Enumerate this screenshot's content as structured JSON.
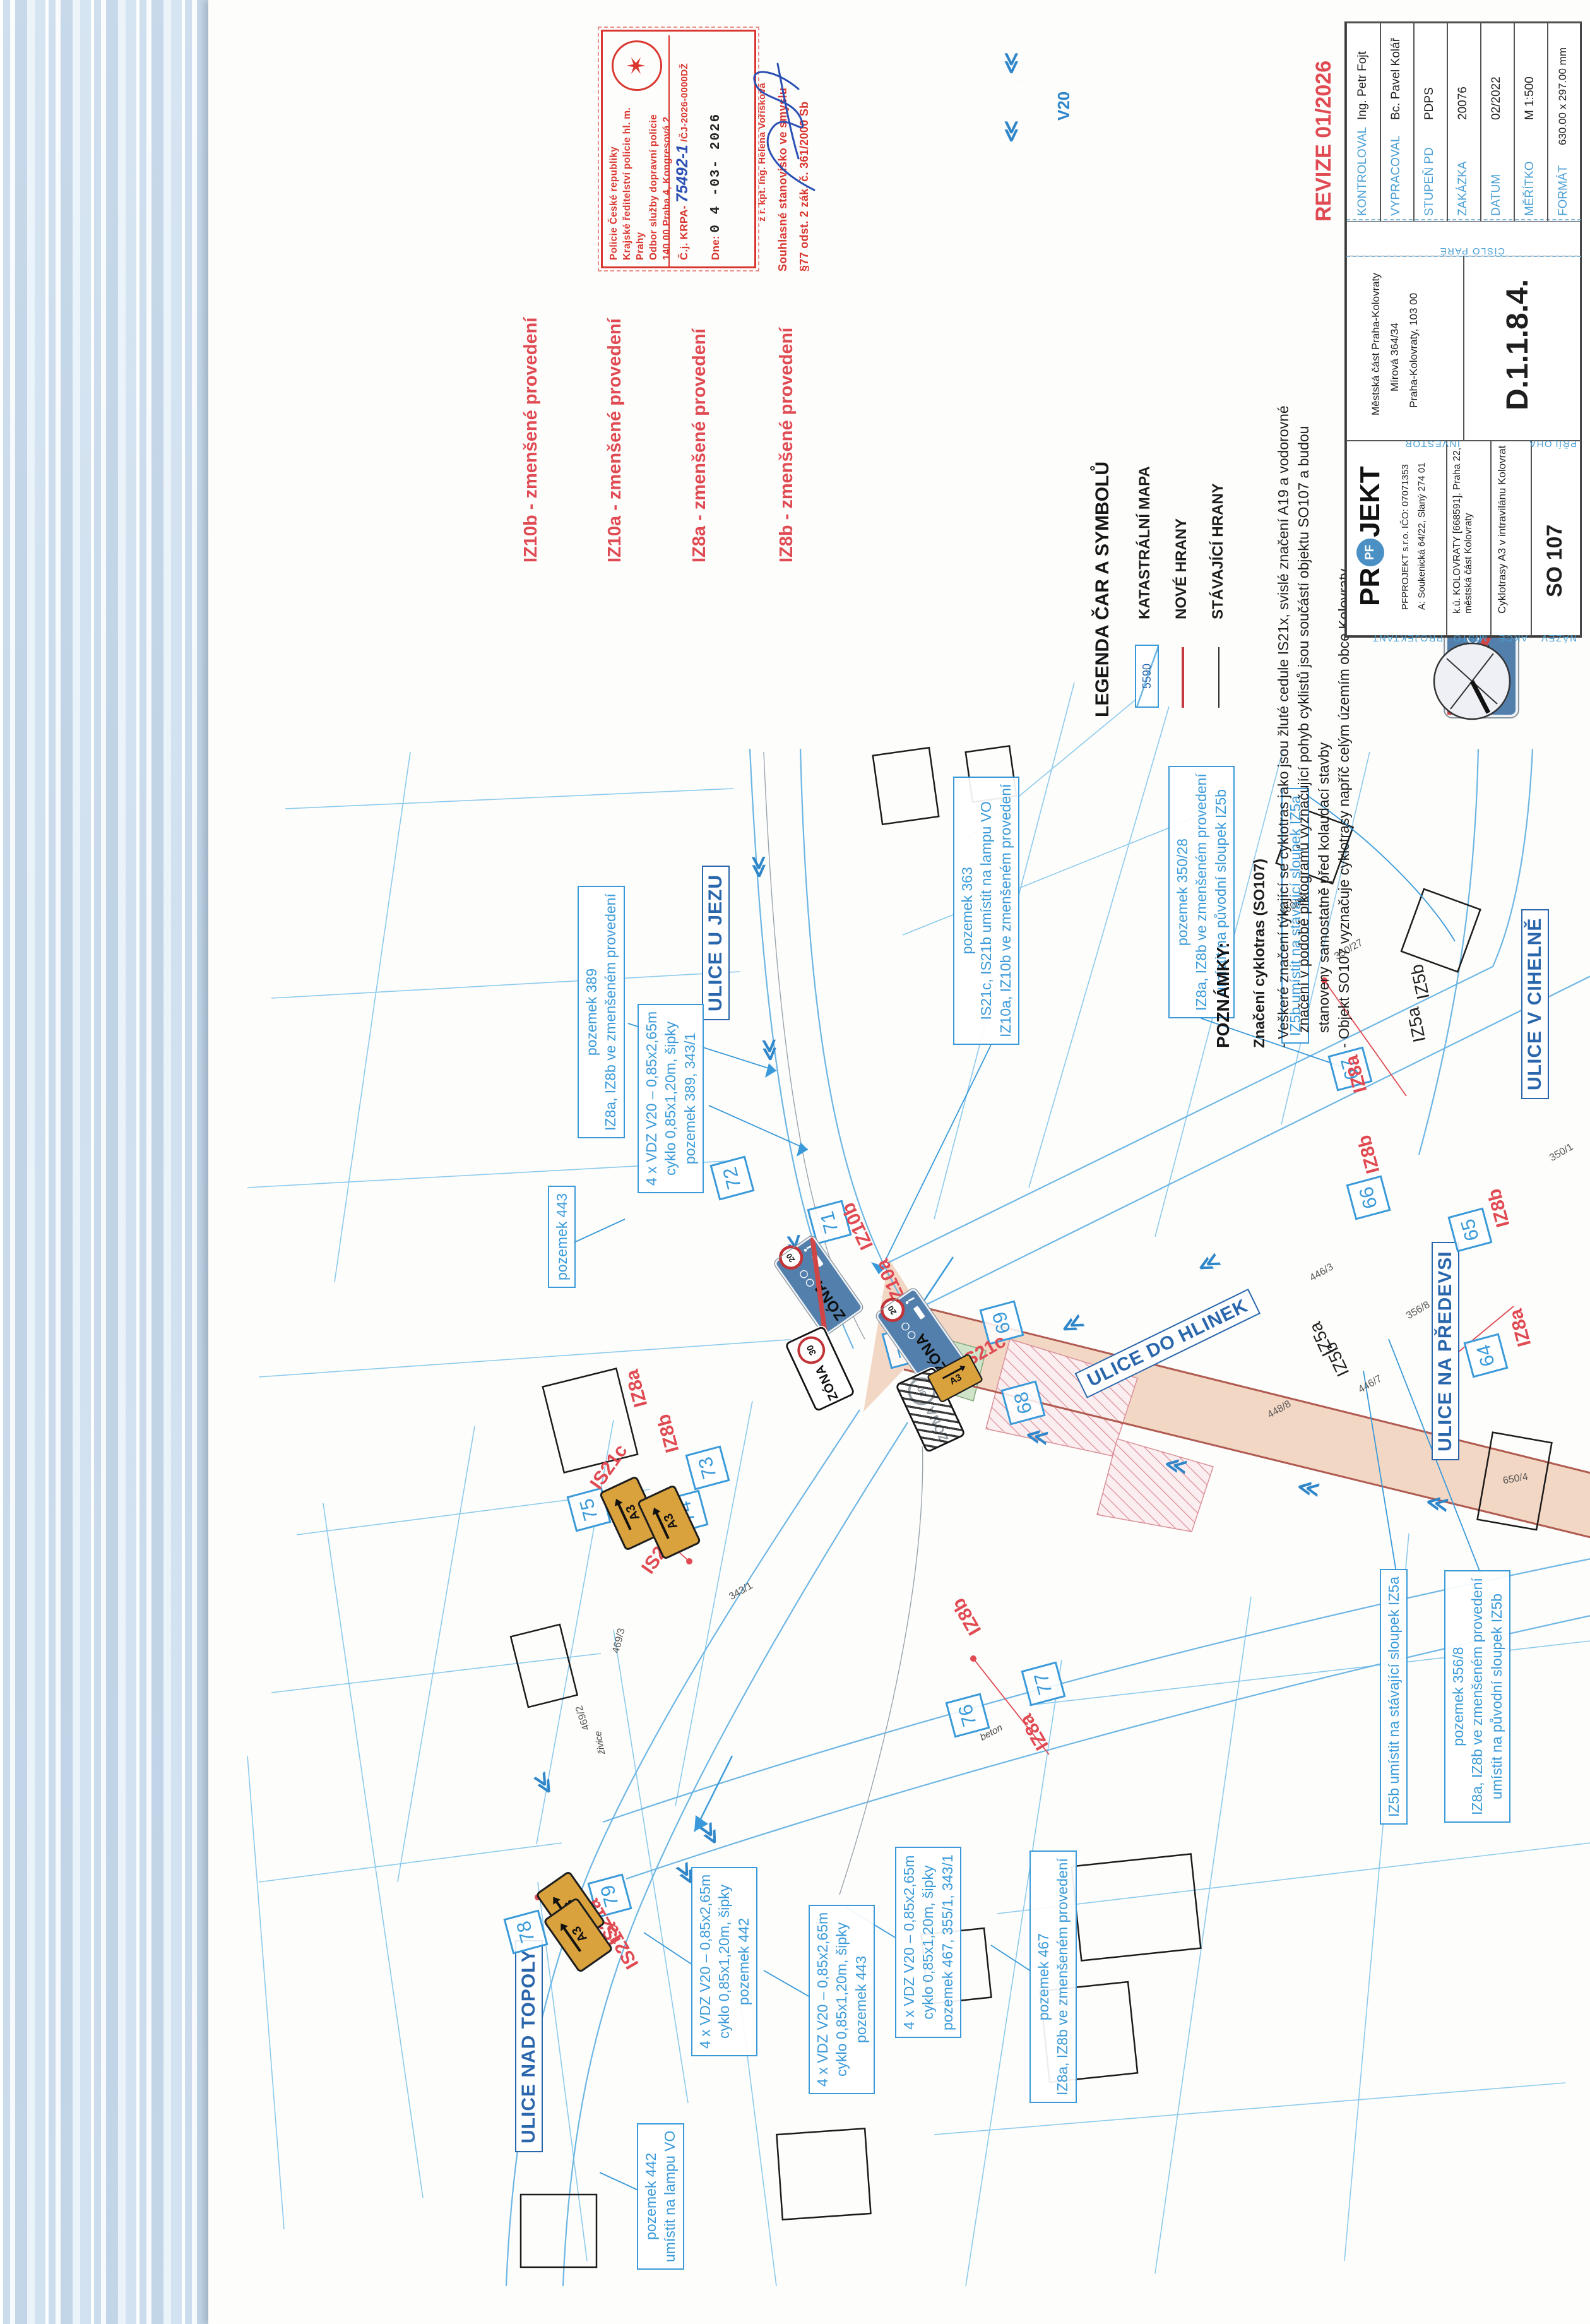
{
  "stamp": {
    "office_lines": [
      "Policie České republiky",
      "Krajské ředitelství policie hl. m. Prahy",
      "Odbor služby dopravní policie",
      "140 00 Praha 4, Kongresová 2"
    ],
    "cj_label": "Č.j. KRPA-",
    "cj_hand": "75492-1",
    "cj_suffix": "/ČJ-2026-0000DŽ",
    "dne_label": "Dne:",
    "dne_value": "0 4 -03- 2026",
    "approval_line1": "Souhlasné stanovisko ve smyslu",
    "approval_line2": "§77 odst. 2 zák. č. 361/2000 Sb",
    "signer": "z r. kpt. Ing. Helena Voříšková"
  },
  "v20": {
    "label": "V20"
  },
  "sign_texts": {
    "zona": "ZÓNA",
    "v20": "20",
    "v30": "30",
    "a3": "A3"
  },
  "legend_signs": [
    {
      "code": "IZ10b",
      "label": "IZ10b - zmenšené provedení"
    },
    {
      "code": "IZ10a",
      "label": "IZ10a - zmenšené provedení"
    },
    {
      "code": "IZ8a",
      "label": "IZ8a - zmenšené provedení"
    },
    {
      "code": "IZ8b",
      "label": "IZ8b - zmenšené provedení"
    }
  ],
  "line_legend": {
    "title": "LEGENDA ČAR A SYMBOLŮ",
    "cadastre_number": "5590",
    "items": [
      "KATASTRÁLNÍ MAPA",
      "NOVÉ HRANY",
      "STÁVAJÍCÍ HRANY"
    ]
  },
  "notes": {
    "title": "POZNÁMKY:",
    "subtitle": "Značení cyklotras (SO107)",
    "lines": [
      "- Veškeré značení týkající se cyklotras jako jsou žluté cedule IS21x, svislé značení A19 a vodorovné",
      "značení v podobě piktogramů vyznačující pohyb cyklistů jsou součástí objektu SO107 a budou",
      "stanoveny samostatně před kolaudací stavby",
      "- Objekt SO107 vyznačuje cyklotrasy napříč celým územím obce Kolovraty"
    ]
  },
  "titleblock": {
    "revision": "REVIZE 01/2026",
    "rows": [
      {
        "label": "KONTROLOVAL",
        "value": "Ing. Petr Fojt"
      },
      {
        "label": "VYPRACOVAL",
        "value": "Bc. Pavel Kolář"
      },
      {
        "label": "STUPEŇ PD",
        "value": "PDPS"
      },
      {
        "label": "ZAKÁZKA",
        "value": "20076"
      },
      {
        "label": "DATUM",
        "value": "02/2022"
      },
      {
        "label": "MĚŘÍTKO",
        "value": "M 1:500"
      },
      {
        "label": "FORMÁT",
        "value": "630.00 x 297.00 mm"
      }
    ],
    "cislo_pare_label": "ČÍSLO PARÉ",
    "priloha_label": "PŘÍLOHA",
    "priloha_value": "D.1.1.8.4.",
    "investor_label": "INVESTOR",
    "investor_lines": [
      "Městská část  Praha-Kolovraty",
      "Mírová 364/34",
      "Praha-Kolovraty,  103 00"
    ],
    "projektant_label": "PROJEKTANT",
    "logo_pre": "PR",
    "logo_mid": "PF",
    "logo_post": "JEKT",
    "company_line1": "PFPROJEKT  s.r.o.    IČO: 07071353",
    "company_line2": "A: Soukenická  64/22,  Slaný  274 01",
    "misto_label": "MÍSTO",
    "misto_value": "k.ú. KOLOVRATY [668591], Praha 22, městská část Kolovraty",
    "akce_label": "AKCE",
    "akce_value": "Cyklotrasy A3 v intravilánu Kolovrat",
    "nazev_label": "NÁZEV",
    "nazev_value": "SO 107"
  },
  "map": {
    "street_labels": [
      "ULICE U JEZU",
      "ULICE V CIHELNĚ",
      "ULICE DO HLINEK",
      "ULICE NA PŘEDEVSI",
      "ULICE NAD TOPOLY"
    ],
    "annotations": [
      {
        "lines": [
          "pozemek 389",
          "IZ8a, IZ8b ve zmenšeném provedení"
        ]
      },
      {
        "lines": [
          "4 x VDZ V20 – 0,85x2,65m",
          "cyklo 0,85x1,20m, šipky",
          "pozemek 389, 343/1"
        ]
      },
      {
        "lines": [
          "pozemek 443"
        ]
      },
      {
        "lines": [
          "pozemek 363",
          "IS21c, IS21b umístit na lampu VO",
          "IZ10a, IZ10b ve zmenšeném provedení"
        ]
      },
      {
        "lines": [
          "pozemek 350/28",
          "IZ8a, IZ8b ve zmenšeném provedení",
          "umístit na původní sloupek IZ5b"
        ]
      },
      {
        "lines": [
          "IZ5b umístit na stávající sloupek IZ5a"
        ]
      },
      {
        "lines": [
          "IZ5b umístit na stávající sloupek IZ5a"
        ]
      },
      {
        "lines": [
          "pozemek 356/8",
          "IZ8a, IZ8b ve zmenšeném provedení",
          "umístit na původní sloupek IZ5b"
        ]
      },
      {
        "lines": [
          "4 x VDZ V20 – 0,85x2,65m",
          "cyklo 0,85x1,20m, šipky",
          "pozemek 442"
        ]
      },
      {
        "lines": [
          "4 x VDZ V20 – 0,85x2,65m",
          "cyklo 0,85x1,20m, šipky",
          "pozemek 443"
        ]
      },
      {
        "lines": [
          "4 x VDZ V20 – 0,85x2,65m",
          "cyklo 0,85x1,20m, šipky",
          "pozemek 467, 355/1, 343/1"
        ]
      },
      {
        "lines": [
          "pozemek 467",
          "IZ8a, IZ8b ve zmenšeném provedení"
        ]
      },
      {
        "lines": [
          "pozemek 442",
          "umístit na lampu VO"
        ]
      }
    ],
    "markers": [
      "71",
      "72",
      "70",
      "69",
      "68",
      "67",
      "66",
      "65",
      "64",
      "73",
      "74",
      "75",
      "76",
      "77",
      "78",
      "79"
    ],
    "sign_labels": [
      "IZ10b",
      "IZ10a",
      "IS21c",
      "IS21c",
      "IS21b",
      "IZ8a",
      "IZ8b",
      "IZ8a",
      "IZ8b",
      "IZ8b",
      "IZ8a",
      "IZ8b",
      "IZ8a",
      "IS21a",
      "IS21a"
    ],
    "black_labels": [
      "IZ5b",
      "IZ5a",
      "IZ5a",
      "IZ5b"
    ],
    "parcel_labels": [
      "343/1",
      "350/28",
      "350/27",
      "350/1",
      "356/8",
      "446/3",
      "446/7",
      "469/2",
      "469/3",
      "650/4",
      "448/8"
    ],
    "surface_labels": [
      "živice",
      "beton"
    ]
  }
}
